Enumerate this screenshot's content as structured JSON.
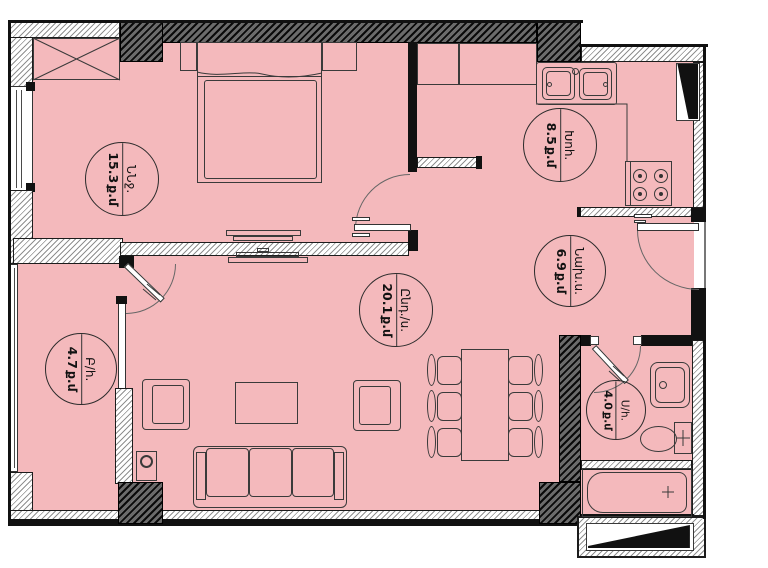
{
  "title": "apartment-floor-plan",
  "rooms": [
    {
      "key": "bedroom",
      "name": "ՆՆջ.",
      "area": "15.3",
      "unit": "ք.մ"
    },
    {
      "key": "kitchen",
      "name": "Խոհ.",
      "area": "8.5",
      "unit": "ք.մ"
    },
    {
      "key": "hallway",
      "name": "Նախ.ս.",
      "area": "6.9",
      "unit": "ք.մ"
    },
    {
      "key": "living-room",
      "name": "Ընդ./ս.",
      "area": "20.1",
      "unit": "ք.մ"
    },
    {
      "key": "balcony",
      "name": "Բ/հ.",
      "area": "4.7",
      "unit": "ք.մ"
    },
    {
      "key": "bathroom",
      "name": "Ս/հ.",
      "area": "4.0",
      "unit": "ք.մ"
    }
  ],
  "colors": {
    "room_fill": "#f4b9bc",
    "wall": "#111111",
    "line": "#3a3a3a",
    "label_text": "#111111"
  }
}
